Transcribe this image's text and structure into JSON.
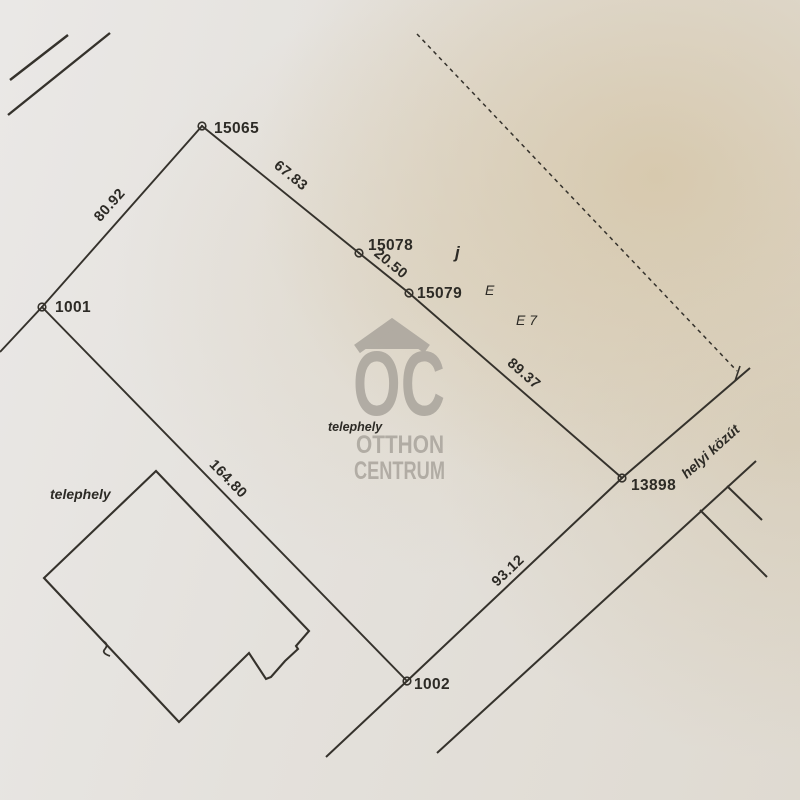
{
  "points": {
    "p15065": "15065",
    "p15078": "15078",
    "p15079": "15079",
    "p1001": "1001",
    "p13898": "13898",
    "p1002": "1002"
  },
  "distances": {
    "d_1001_15065": "80.92",
    "d_15065_15078": "67.83",
    "d_15078_15079": "20.50",
    "d_15079_13898": "89.37",
    "d_13898_1002": "93.12",
    "d_1001_1002": "164.80"
  },
  "annotations": {
    "telephely_left": "telephely",
    "telephely_center": "telephely",
    "letter_j": "j",
    "letter_e": "E",
    "letter_e7": "E 7",
    "road_name": "helyi közút"
  },
  "watermark": {
    "logo": "OC",
    "line1": "OTTHON",
    "line2": "CENTRUM"
  },
  "colors": {
    "ink": "#35322c",
    "watermark_gray": "#a6a199",
    "paper": "#e4e1dc"
  }
}
